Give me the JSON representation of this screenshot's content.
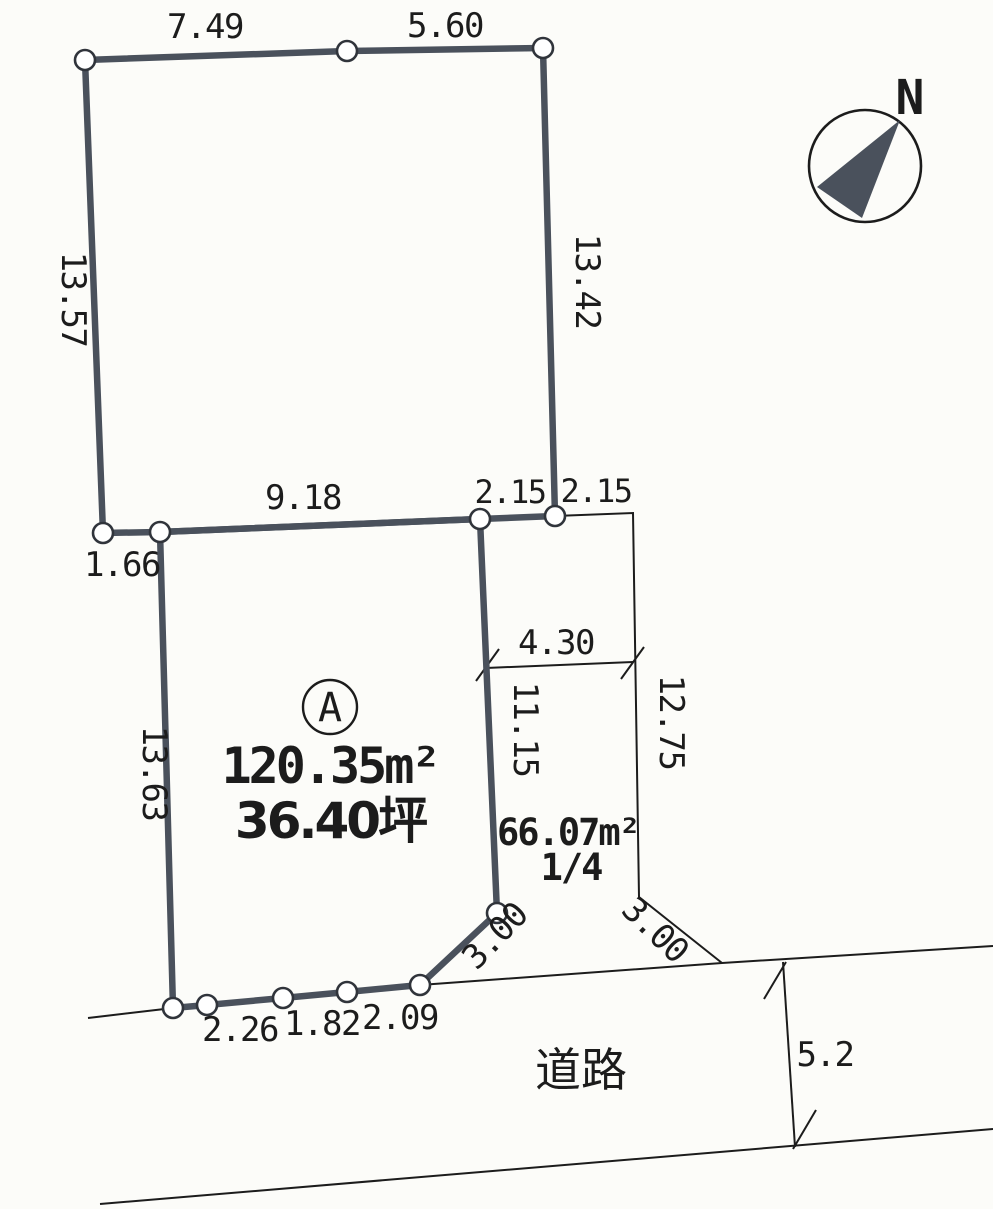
{
  "diagram": {
    "type": "land-survey-plot",
    "compass": {
      "north_label": "N"
    },
    "parcel_a": {
      "id_label": "A",
      "area_m2": "120.35m²",
      "area_tsubo": "36.40坪"
    },
    "shared_parcel": {
      "area_m2": "66.07m²",
      "share": "1/4"
    },
    "road": {
      "label": "道路",
      "width": "5.2"
    },
    "dimensions": {
      "top_left_edge": "7.49",
      "top_right_edge": "5.60",
      "left_upper_edge": "13.57",
      "right_upper_edge": "13.42",
      "mid_long_edge": "9.18",
      "mid_short_left": "2.15",
      "mid_short_right": "2.15",
      "left_step_edge": "1.66",
      "inner_width": "4.30",
      "inner_vertical_edge": "11.15",
      "right_lower_edge": "12.75",
      "left_lower_edge": "13.63",
      "diag_left_edge": "3.00",
      "diag_right_edge": "3.00",
      "bottom_edge_1": "2.26",
      "bottom_edge_2": "1.82",
      "bottom_edge_3": "2.09"
    },
    "colors": {
      "boundary_thick": "#4a515c",
      "line_thin": "#1c1c1c",
      "paper": "#fcfcf9"
    }
  }
}
